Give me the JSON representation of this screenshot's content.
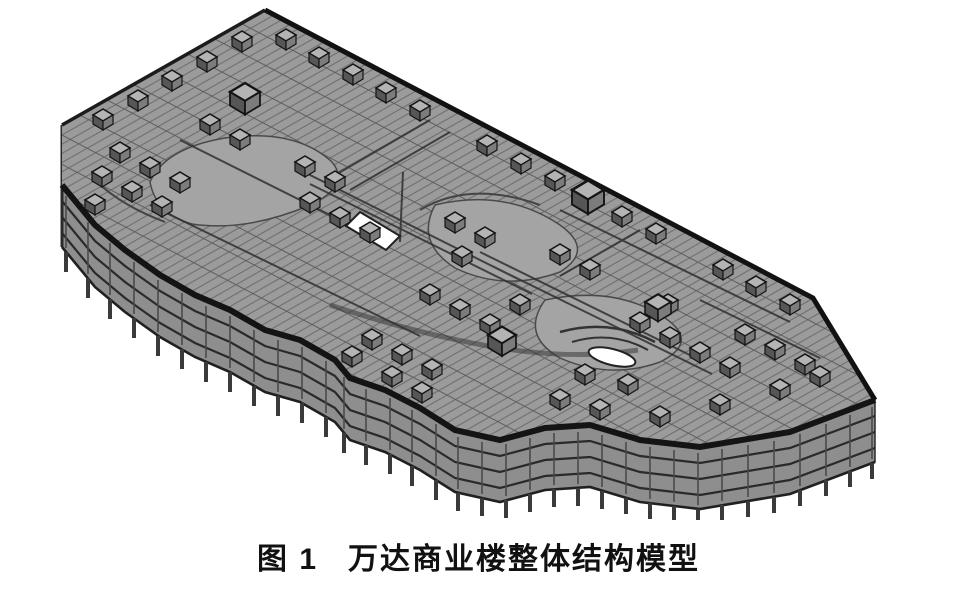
{
  "page": {
    "background": "#ffffff"
  },
  "figure": {
    "label": "图 1",
    "title": "万达商业楼整体结构模型",
    "colors": {
      "roof": "#9b9b9b",
      "roof_zone": "#a4a4a4",
      "facade": "#8e8e8e",
      "edge": "#141414",
      "slab": "#2a2a2a",
      "column": "#3a3a3a",
      "box_top": "#b4b4b4",
      "box_left": "#565656",
      "box_right": "#7c7c7c",
      "void": "#ffffff",
      "caption_text": "#111111"
    }
  }
}
